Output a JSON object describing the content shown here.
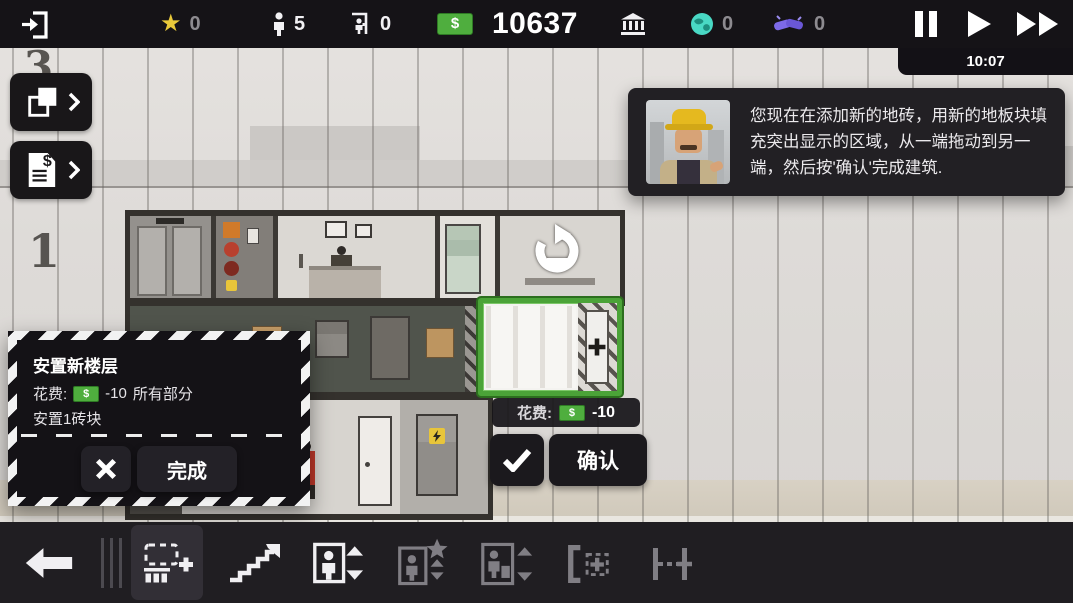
{
  "top_bar": {
    "stats": {
      "prestige": "0",
      "staff": "5",
      "visitors": "0",
      "money": "10637",
      "currency_symbol": "$",
      "influence": "0",
      "contacts": "0"
    },
    "time": "10:07"
  },
  "floor_labels": {
    "top": "3",
    "lobby": "1"
  },
  "tutorial": {
    "text": "您现在在添加新的地砖，用新的地板块填充突出显示的区域，从一端拖动到另一端，然后按'确认'完成建筑."
  },
  "build_panel": {
    "title": "安置新楼层",
    "cost_label": "花费:",
    "currency_symbol": "$",
    "cost_value": "-10",
    "cost_scope": "所有部分",
    "detail": "安置1砖块",
    "done_label": "完成"
  },
  "placement": {
    "cost_label": "花费:",
    "currency_symbol": "$",
    "cost_value": "-10",
    "confirm_label": "确认"
  },
  "colors": {
    "accent_green": "#4ba338",
    "money_green": "#4fae3e",
    "star_yellow": "#e9c93a",
    "influence_teal": "#49d8c4",
    "contacts_purple": "#7d6ae8",
    "panel_black": "#141216",
    "toolbar_dark": "#201e22"
  }
}
